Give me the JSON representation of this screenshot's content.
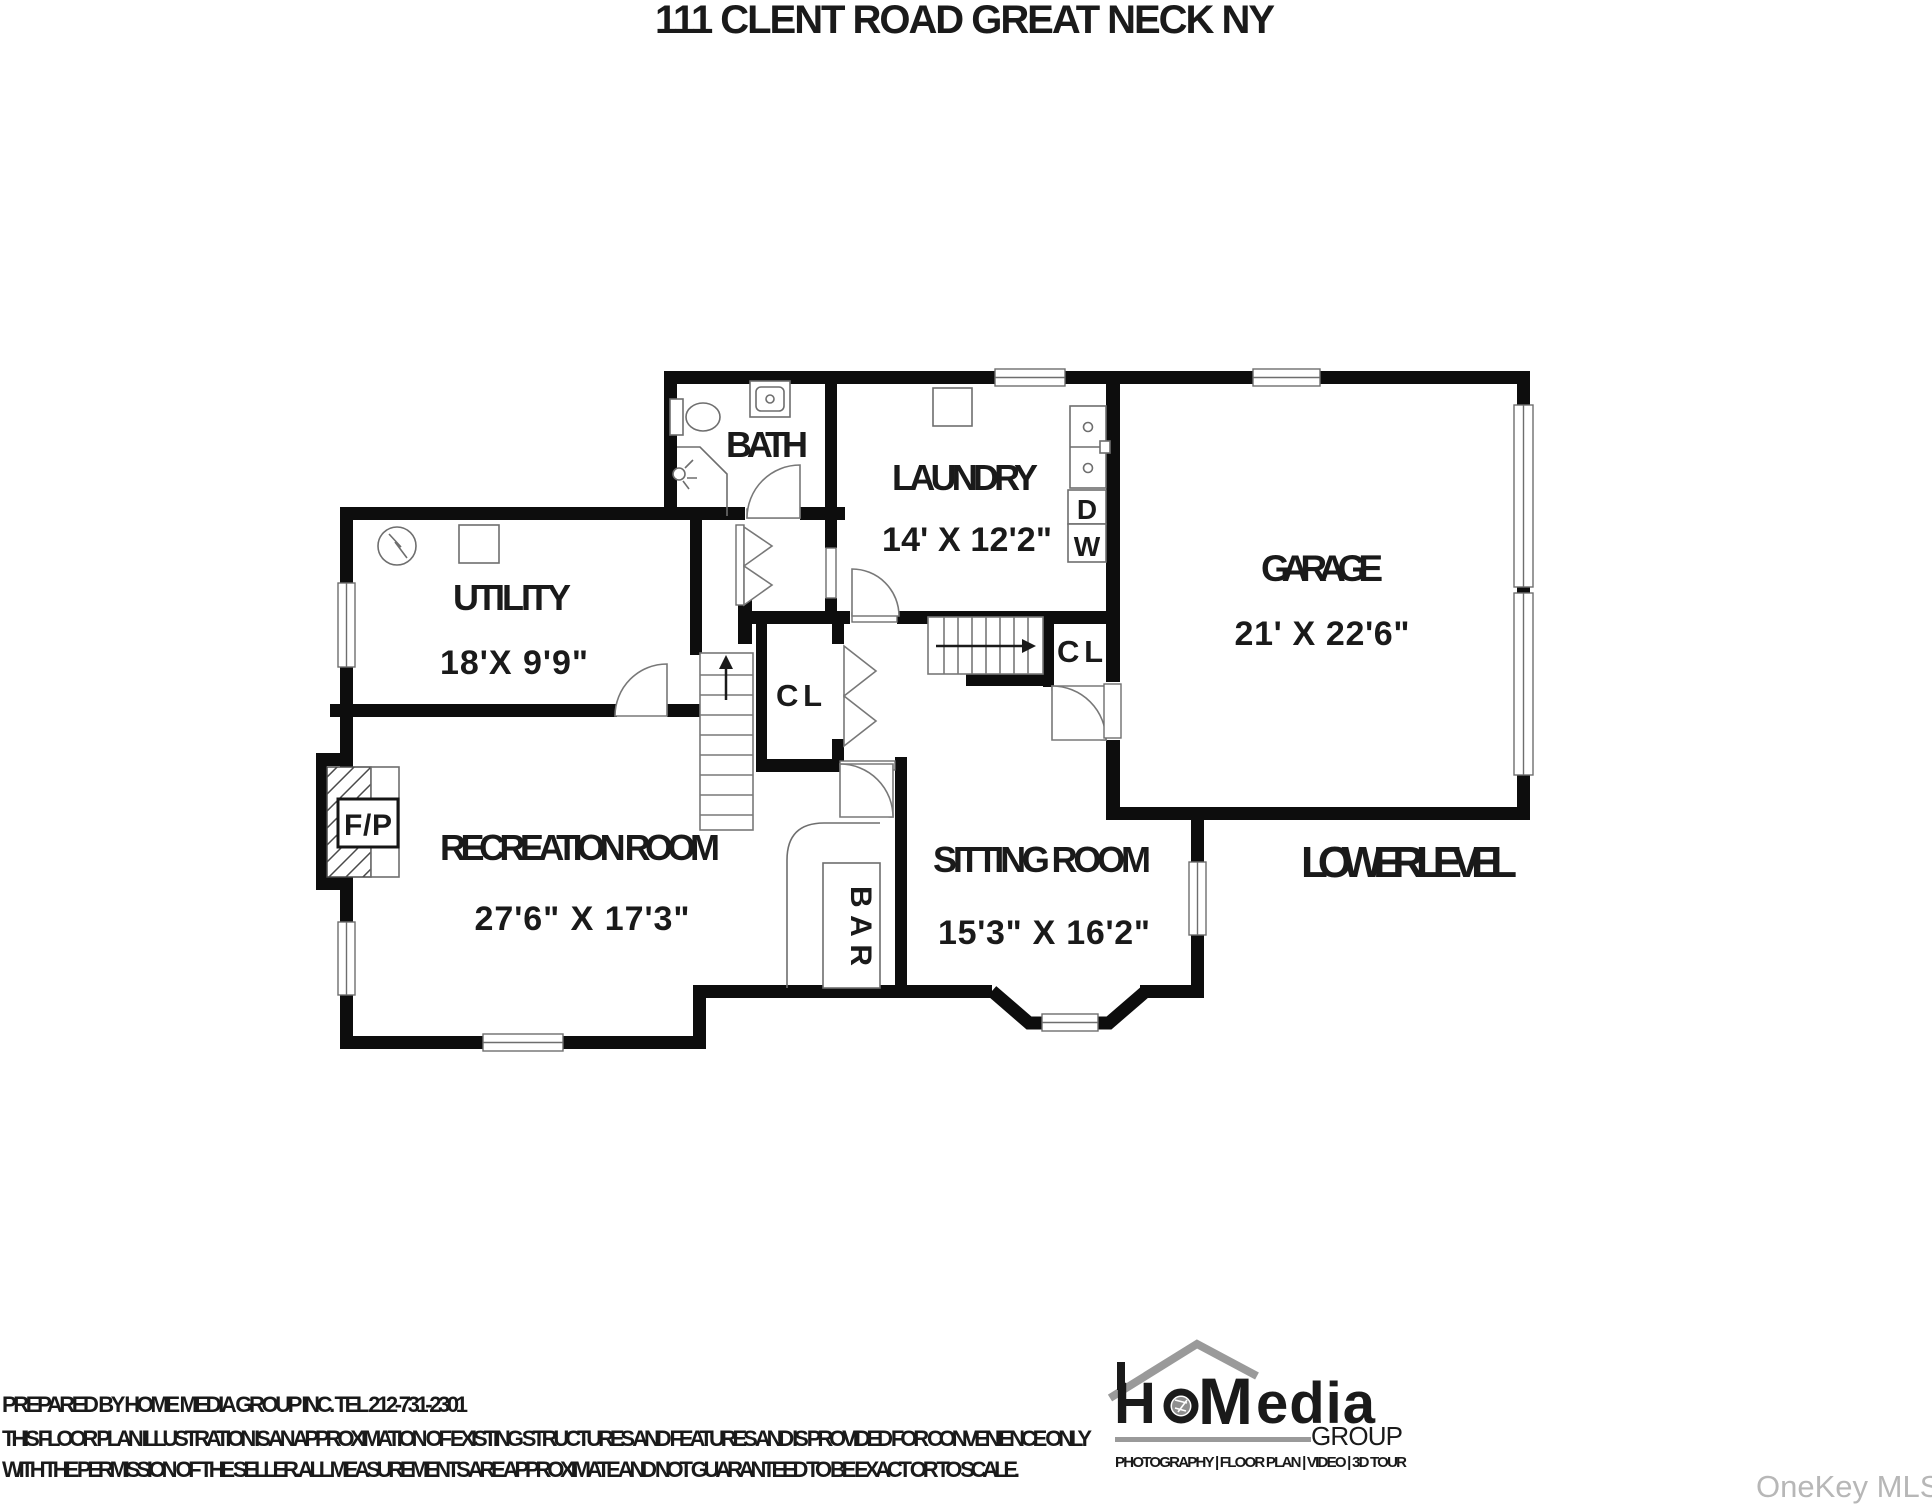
{
  "title": "111 CLENT ROAD GREAT NECK NY",
  "floor_label": "LOWER LEVEL",
  "rooms": {
    "bath": {
      "name": "BATH"
    },
    "laundry": {
      "name": "LAUNDRY",
      "dims": "14' X 12'2\"",
      "dryer": "D",
      "washer": "W"
    },
    "garage": {
      "name": "GARAGE",
      "dims": "21' X 22'6\""
    },
    "utility": {
      "name": "UTILITY",
      "dims": "18'X 9'9\""
    },
    "recreation": {
      "name": "RECREATION ROOM",
      "dims": "27'6\" X 17'3\""
    },
    "sitting": {
      "name": "SITTING ROOM",
      "dims": "15'3\" X 16'2\""
    },
    "closet_hall": {
      "name": "CL"
    },
    "closet_garage": {
      "name": "CL"
    },
    "bar": {
      "name": "BAR"
    },
    "fireplace": {
      "name": "F/P"
    }
  },
  "footer": {
    "line1": "PREPARED BY  HOME MEDIA GROUP INC.  TEL 212-731-2301",
    "line2": "THIS FLOOR PLAN ILLUSTRATION IS AN APPROXIMATION OF EXISTING STRUCTURES AND FEATURES AND IS PROVIDED FOR CONVENIENCE ONLY",
    "line3": "WITH THE PERMISSION OF THE SELLER. ALL MEASUREMENTS ARE APPROXIMATE AND NOT GUARANTEED TO BE EXACT OR TO SCALE."
  },
  "logo": {
    "h": "H",
    "m": "M",
    "edia": "edia",
    "group": "GROUP",
    "tagline": "PHOTOGRAPHY | FLOOR PLAN | VIDEO | 3D TOUR"
  },
  "watermark": "OneKey MLS"
}
